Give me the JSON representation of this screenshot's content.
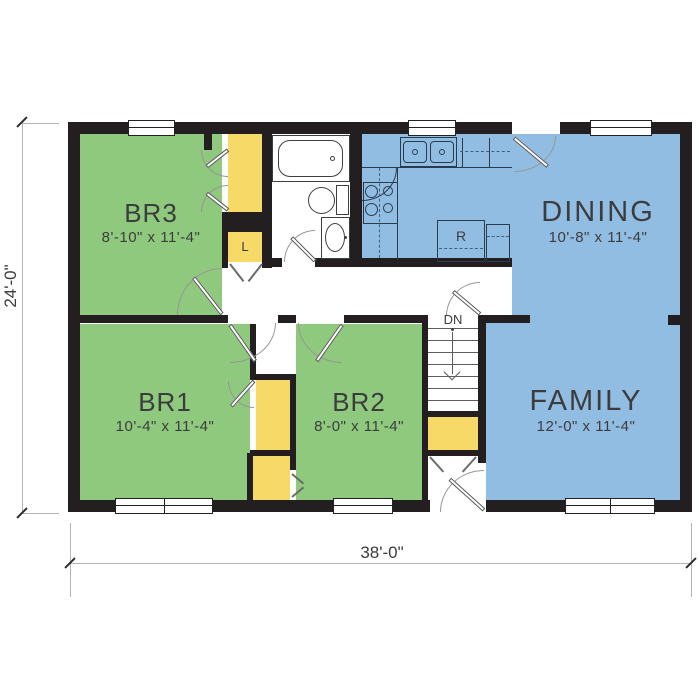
{
  "plan": {
    "rooms": {
      "br3": {
        "name": "BR3",
        "size": "8'-10\" x 11'-4\""
      },
      "br1": {
        "name": "BR1",
        "size": "10'-4\" x 11'-4\""
      },
      "br2": {
        "name": "BR2",
        "size": "8'-0\" x 11'-4\""
      },
      "dining": {
        "name": "DINING",
        "size": "10'-8\" x 11'-4\""
      },
      "family": {
        "name": "FAMILY",
        "size": "12'-0\" x 11'-4\""
      }
    },
    "labels": {
      "stairs_down": "DN",
      "linen_closet": "L",
      "refrigerator": "R"
    },
    "overall_dimensions": {
      "width": "38'-0\"",
      "depth": "24'-0\""
    },
    "colors": {
      "wall": "#231f20",
      "bedroom_fill": "#8fc97e",
      "living_fill": "#92bde2",
      "closet_fill": "#f6d967"
    }
  }
}
